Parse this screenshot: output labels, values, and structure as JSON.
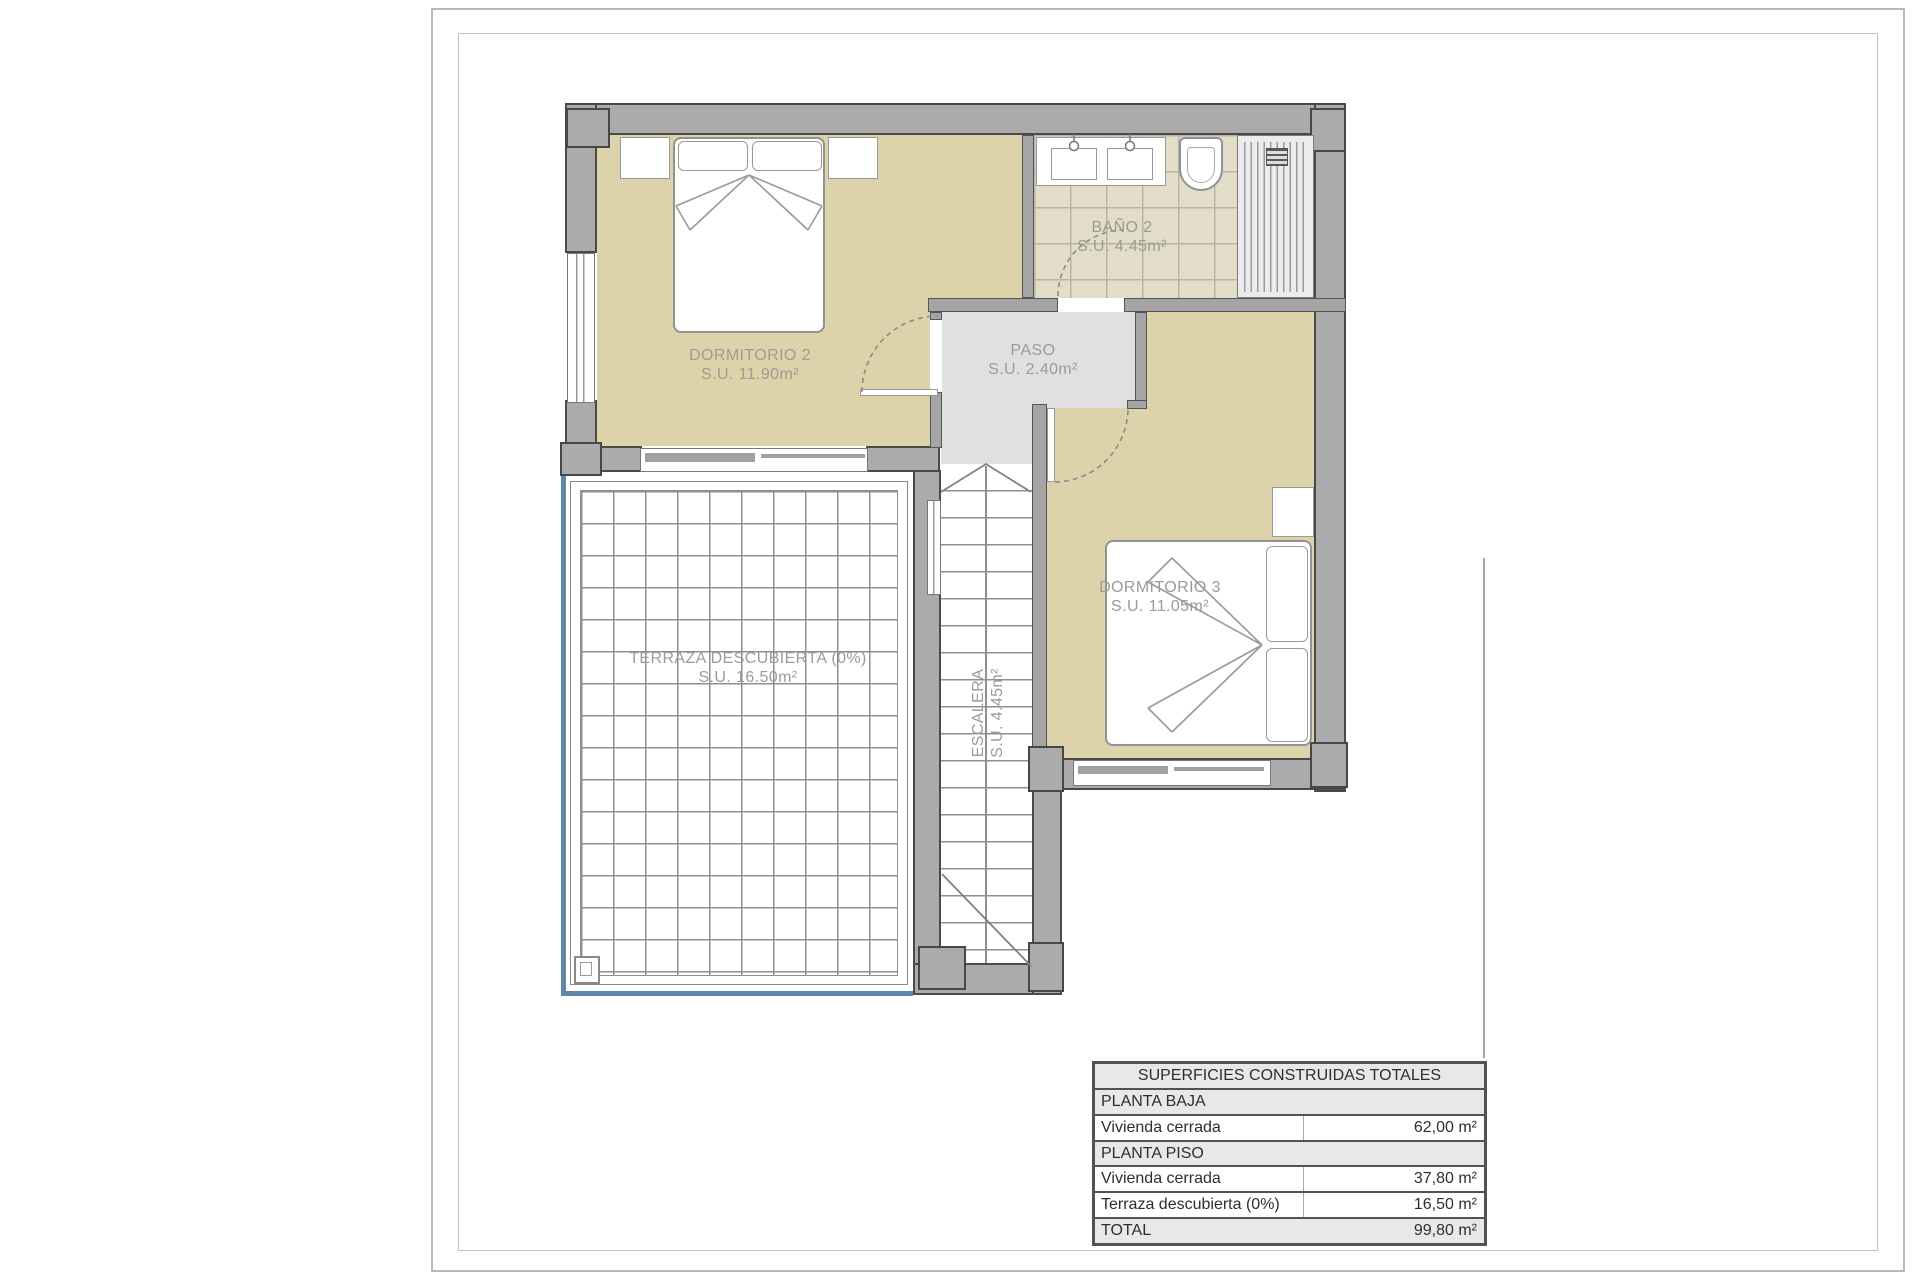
{
  "plan": {
    "rooms": {
      "dormitorio2": {
        "name": "DORMITORIO 2",
        "area": "S.U. 11.90m²"
      },
      "bano2": {
        "name": "BAÑO 2",
        "area": "S.U. 4.45m²"
      },
      "paso": {
        "name": "PASO",
        "area": "S.U. 2.40m²"
      },
      "dormitorio3": {
        "name": "DORMITORIO 3",
        "area": "S.U. 11.05m²"
      },
      "escalera": {
        "name": "ESCALERA",
        "area": "S.U. 4.45m²"
      },
      "terraza": {
        "name": "TERRAZA DESCUBIERTA (0%)",
        "area": "S.U. 16.50m²"
      }
    },
    "colors": {
      "floor_tan": "#ddd3ab",
      "wall_gray": "#ababab",
      "corridor_gray": "#e0e0e0",
      "railing_blue": "#5d86ab",
      "label_gray": "#9c9c94"
    }
  },
  "summary_table": {
    "title": "SUPERFICIES CONSTRUIDAS TOTALES",
    "rows": [
      {
        "label": "PLANTA BAJA",
        "value": ""
      },
      {
        "label": "Vivienda cerrada",
        "value": "62,00 m²"
      },
      {
        "label": "PLANTA PISO",
        "value": ""
      },
      {
        "label": "Vivienda cerrada",
        "value": "37,80 m²"
      },
      {
        "label": "Terraza descubierta (0%)",
        "value": "16,50 m²"
      },
      {
        "label": "TOTAL",
        "value": "99,80 m²"
      }
    ]
  }
}
